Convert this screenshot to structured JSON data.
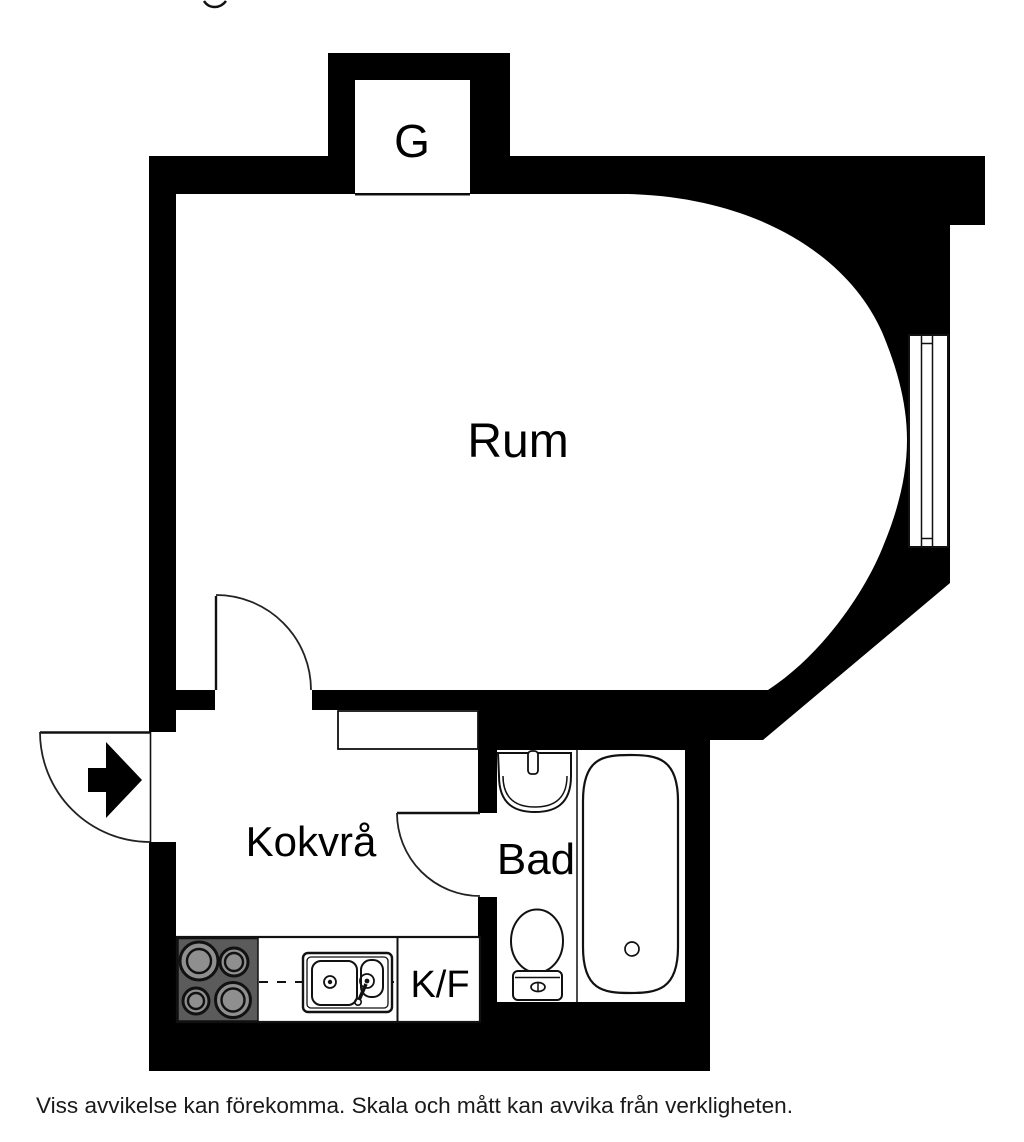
{
  "title_fragment": "g",
  "floorplan": {
    "closet_label": "G",
    "room_label": "Rum",
    "kitchenette_label": "Kokvrå",
    "bathroom_label": "Bad",
    "fridge_freezer_label": "K/F",
    "disclaimer": "Viss avvikelse kan förekomma. Skala och mått kan avvika från verkligheten.",
    "colors": {
      "wall": "#000000",
      "background": "#ffffff",
      "stove": "#5b5b5b",
      "burner": "#8f8f8f"
    }
  }
}
